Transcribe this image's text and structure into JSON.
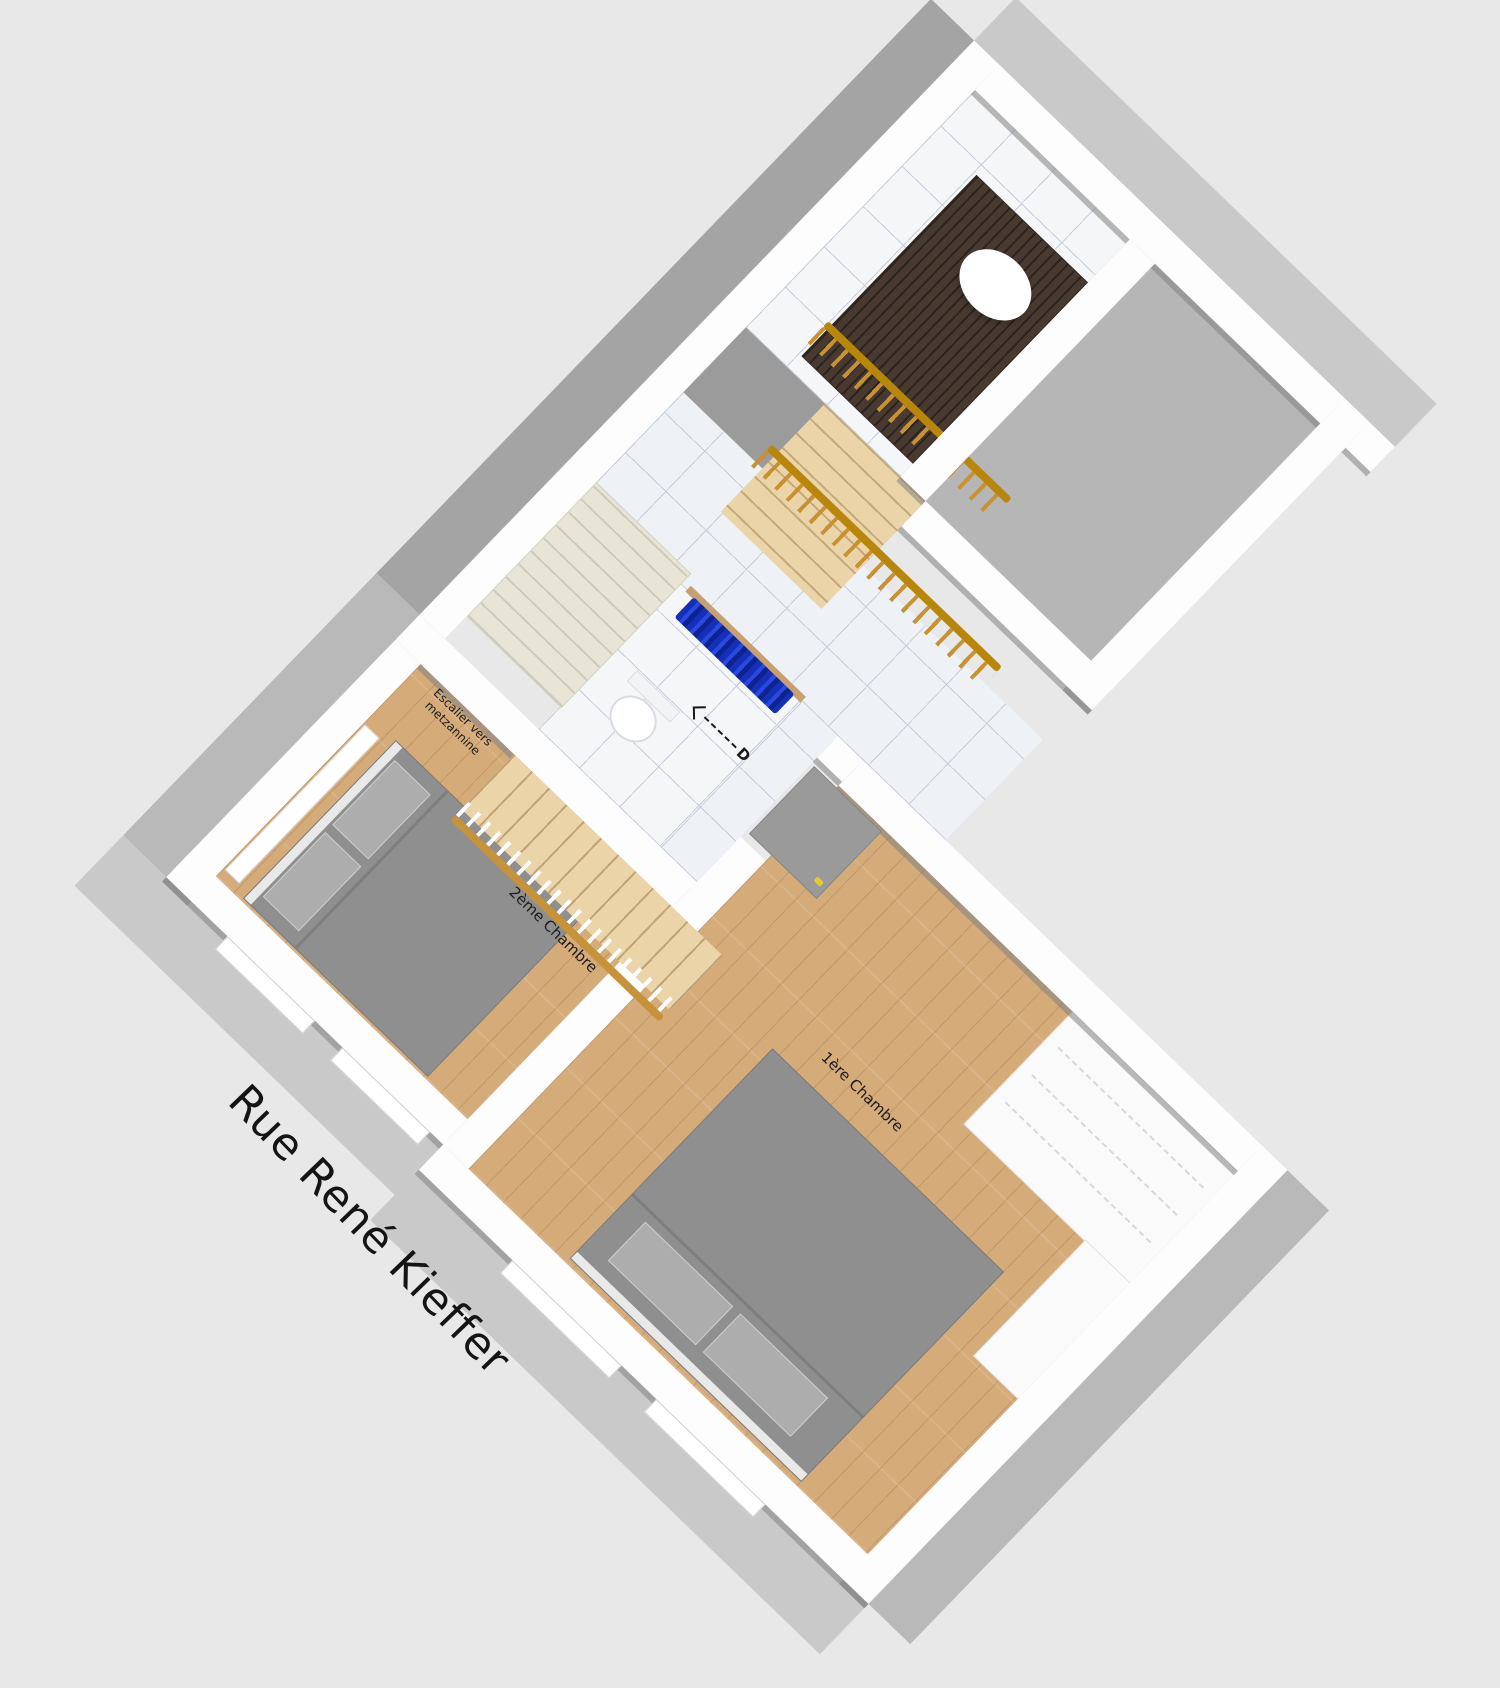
{
  "floor_plan": {
    "title": "3D floor plan render of an apartment upper floor",
    "street_label": "Rue René Kieffer",
    "labels": {
      "room1": "1ère Chambre",
      "room2": "2ème Chambre",
      "stair_line1": "Escalier vers",
      "stair_line2": "metzannine",
      "door_letter": "D"
    },
    "rooms": [
      {
        "name": "1ère Chambre",
        "floor": "wood parquet"
      },
      {
        "name": "2ème Chambre",
        "floor": "wood parquet"
      },
      {
        "name": "bathroom",
        "floor": "white tile"
      },
      {
        "name": "corridor",
        "floor": "blue-grey tile"
      },
      {
        "name": "stair-hall",
        "floor": "light tile"
      },
      {
        "name": "right-wing-room",
        "floor": "grey"
      }
    ],
    "furniture": [
      "double-bed-room1",
      "double-bed-room2",
      "cream-wardrobe",
      "dark-wood-wardrobe",
      "white-dresser",
      "toilet",
      "blue-shower-curtain",
      "hall-staircase",
      "mezzanine-staircase",
      "gold-railings",
      "ceiling-dome-lamp",
      "door-with-yellow-handle"
    ],
    "annotations": {
      "door_arrow": "dashed arrow pointing up-left labelled D"
    },
    "colors": {
      "background": "#e8e8e8",
      "wall_top": "#fdfdfd",
      "wall_face": "#9b9b9b",
      "wood_floor": "#d5ab7a",
      "stair_wood": "#ecd4a9",
      "tile": "#eef1f6",
      "tile_line": "#c6ccd8",
      "bed_grey": "#8f8f8f",
      "curtain_blue": "#1d36c0",
      "railing_gold": "#b8860b",
      "dark_wardrobe": "#483a30",
      "cream_wardrobe": "#e9e5d6",
      "door_handle_yellow": "#e6c832"
    }
  }
}
